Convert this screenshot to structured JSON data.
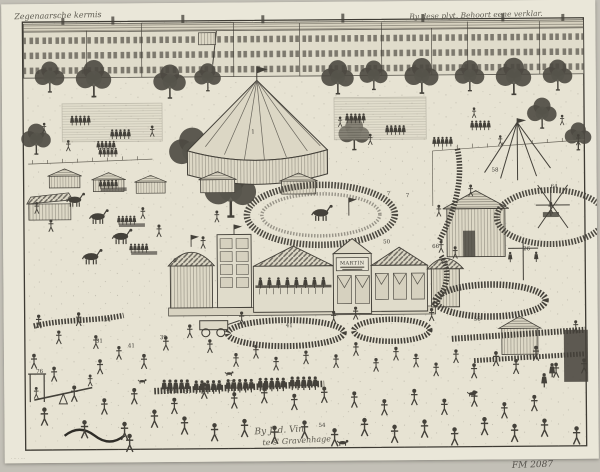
{
  "artwork": {
    "type": "etching of a fair (kermis) scene",
    "inscriptions": {
      "top_left": "Zegenaarsche kermis",
      "top_right": "By dese plyt. Behoort eene verklar.",
      "bottom_center_line1": "By J. d. Vin",
      "bottom_center_line2": "te s' Gravenhage",
      "bottom_right": "FM 2087",
      "bottom_left_mark": "· ·· · ···"
    },
    "labels": {
      "martin_sign": "MARTIN"
    },
    "key_numbers": [
      {
        "n": "1",
        "x": 249,
        "y": 131
      },
      {
        "n": "7",
        "x": 384,
        "y": 194
      },
      {
        "n": "7",
        "x": 403,
        "y": 196
      },
      {
        "n": "58",
        "x": 489,
        "y": 171
      },
      {
        "n": "64",
        "x": 548,
        "y": 188
      },
      {
        "n": "66",
        "x": 429,
        "y": 247
      },
      {
        "n": "6",
        "x": 170,
        "y": 259
      },
      {
        "n": "50",
        "x": 380,
        "y": 242
      },
      {
        "n": "26",
        "x": 520,
        "y": 250
      },
      {
        "n": "34",
        "x": 100,
        "y": 318
      },
      {
        "n": "31",
        "x": 92,
        "y": 339
      },
      {
        "n": "41",
        "x": 124,
        "y": 344
      },
      {
        "n": "39",
        "x": 156,
        "y": 336
      },
      {
        "n": "41",
        "x": 282,
        "y": 325
      },
      {
        "n": "56",
        "x": 470,
        "y": 320
      },
      {
        "n": "38",
        "x": 162,
        "y": 388
      },
      {
        "n": "37",
        "x": 180,
        "y": 391
      },
      {
        "n": "77",
        "x": 222,
        "y": 382
      },
      {
        "n": "76",
        "x": 32,
        "y": 369
      },
      {
        "n": "54",
        "x": 314,
        "y": 425
      }
    ]
  },
  "colors": {
    "scan_background": "#c3c0b7",
    "paper": "#eae7d9",
    "plate_ground": "#e7e3d3",
    "facade": "#e0dccb",
    "ink": "#44413a",
    "ink_light": "#6b675c",
    "pencil": "#55524c"
  }
}
